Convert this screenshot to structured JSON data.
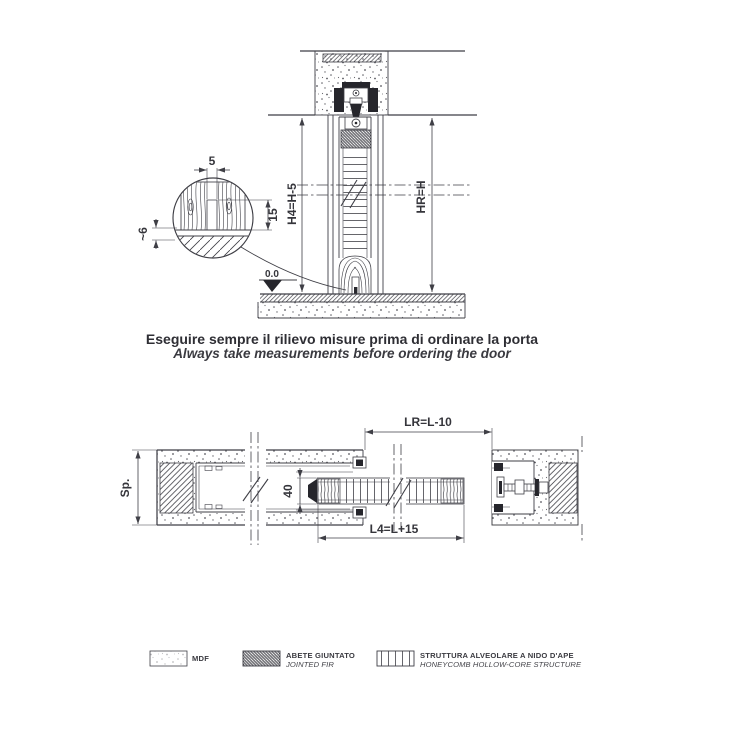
{
  "note": {
    "line1": "Eseguire sempre il rilievo misure prima di ordinare la porta",
    "line2": "Always take measurements before ordering the door"
  },
  "vertical_section": {
    "groove_width": "5",
    "groove_depth": "15",
    "floor_clearance": "~6",
    "door_height": "H4=H-5",
    "opening_height": "HR=H",
    "floor_level": "0.0"
  },
  "horizontal_section": {
    "wall_thickness": "Sp.",
    "door_thickness": "40",
    "clear_passage_width": "LR=L-10",
    "door_width": "L4=L+15"
  },
  "legend": {
    "items": [
      {
        "swatch": "mdf",
        "label_it": "MDF",
        "label_en": ""
      },
      {
        "swatch": "jointed-fir",
        "label_it": "ABETE GIUNTATO",
        "label_en": "JOINTED FIR"
      },
      {
        "swatch": "honeycomb",
        "label_it": "STRUTTURA ALVEOLARE A NIDO D'APE",
        "label_en": "HONEYCOMB HOLLOW-CORE STRUCTURE"
      }
    ]
  },
  "colors": {
    "line": "#3f3f46",
    "dark": "#26262c",
    "text": "#35353b",
    "background": "#ffffff"
  }
}
